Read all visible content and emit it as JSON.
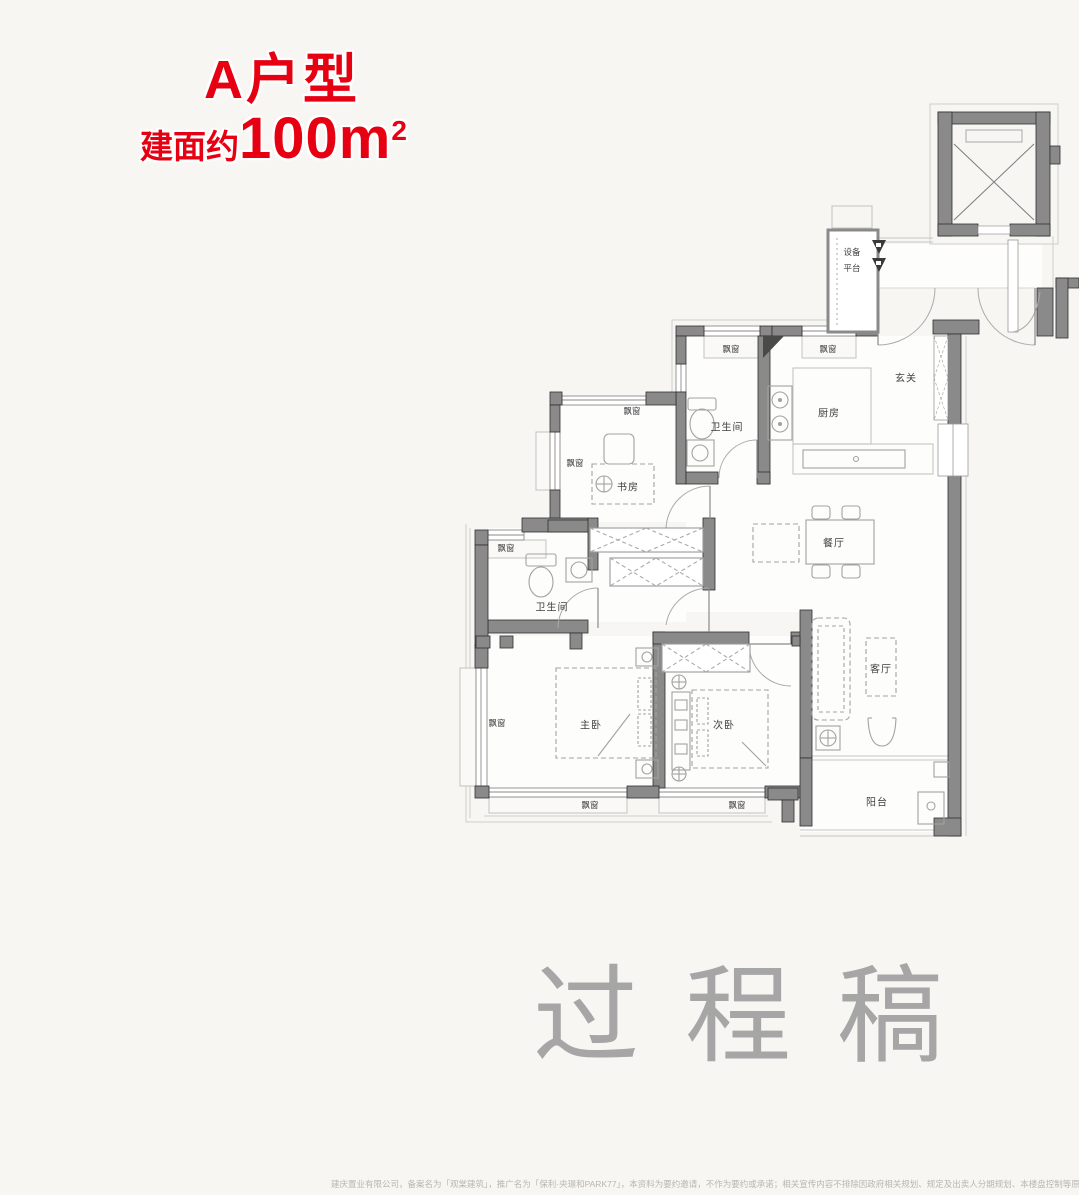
{
  "header": {
    "title": "A户型",
    "area_prefix": "建面约",
    "area_number": "100m",
    "area_sup": "2"
  },
  "colors": {
    "accent_red": "#e60012",
    "wall_gray": "#8a8a8a",
    "watermark_gray": "#a6a6a6"
  },
  "watermark": {
    "text": "过程稿"
  },
  "rooms": {
    "equipment_platform_line1": "设备",
    "equipment_platform_line2": "平台",
    "entry_hall": "玄关",
    "kitchen": "厨房",
    "bathroom_upper": "卫生间",
    "bathroom_lower": "卫生间",
    "study": "书房",
    "dining": "餐厅",
    "master_bedroom": "主卧",
    "second_bedroom": "次卧",
    "living": "客厅",
    "balcony": "阳台",
    "bay_window": "飘窗"
  },
  "disclaimer": "建庆置业有限公司，备案名为「观棠建筑」，推广名为「保利·央璟和PARK77」，本资料为要约邀请，不作为要约或承诺；相关宣传内容不排除因政府相关规划、规定及出卖人分期规划、本楼盘控制等原因而发生变化；买卖双方的权利义"
}
